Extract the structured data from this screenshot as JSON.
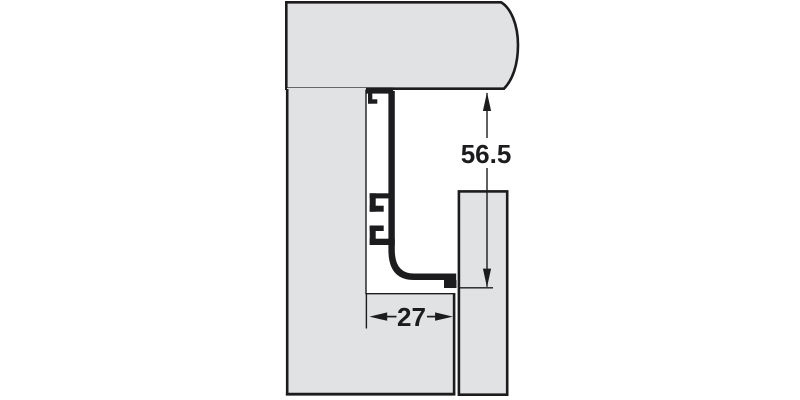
{
  "diagram": {
    "dimension_vertical": {
      "label": "56.5"
    },
    "dimension_horizontal": {
      "label": "27"
    },
    "colors": {
      "panel_fill": "#e1e2e4",
      "outline": "#1c1c1e",
      "background": "#ffffff"
    }
  }
}
